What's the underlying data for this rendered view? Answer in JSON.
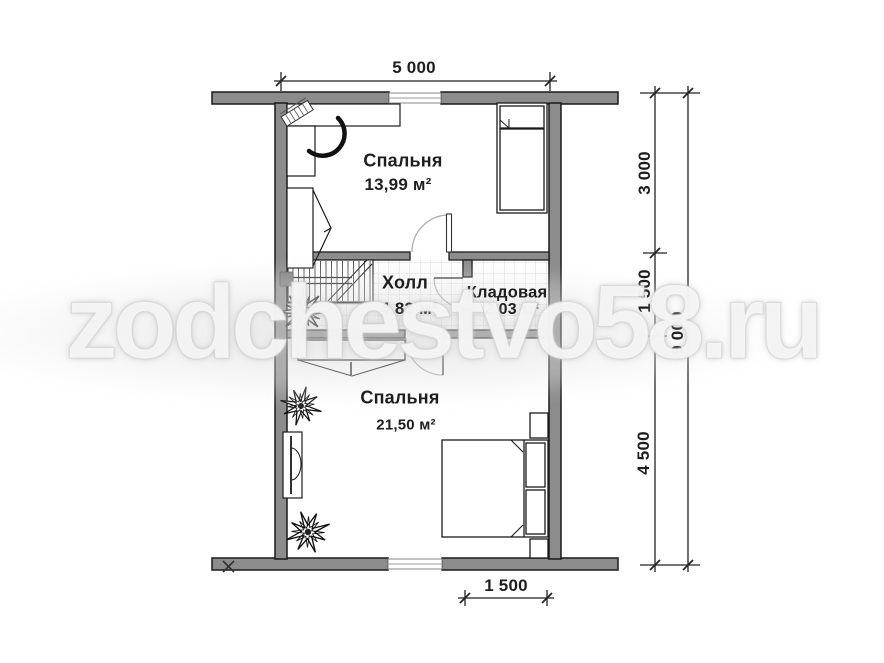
{
  "watermark": {
    "text": "zodchestvo58.ru"
  },
  "plan": {
    "rooms": [
      {
        "id": "bedroom-1",
        "name": "Спальня",
        "area": "13,99 м²"
      },
      {
        "id": "hall",
        "name": "Холл",
        "area": "4,83 м²"
      },
      {
        "id": "storage",
        "name": "Кладовая",
        "area": "2,03 м²"
      },
      {
        "id": "bedroom-2",
        "name": "Спальня",
        "area": "21,50 м²"
      }
    ],
    "dimensions": {
      "width_top": "5 000",
      "height_top": "3 000",
      "height_middle": "1 500",
      "height_bottom": "4 500",
      "height_total": "9 000",
      "width_bottom": "1 500"
    },
    "colors": {
      "wall_fill": "#8c8c8c",
      "line": "#1a1a1a",
      "tile_grid": "#d9d9d9",
      "watermark_text": "#ffffff"
    }
  }
}
